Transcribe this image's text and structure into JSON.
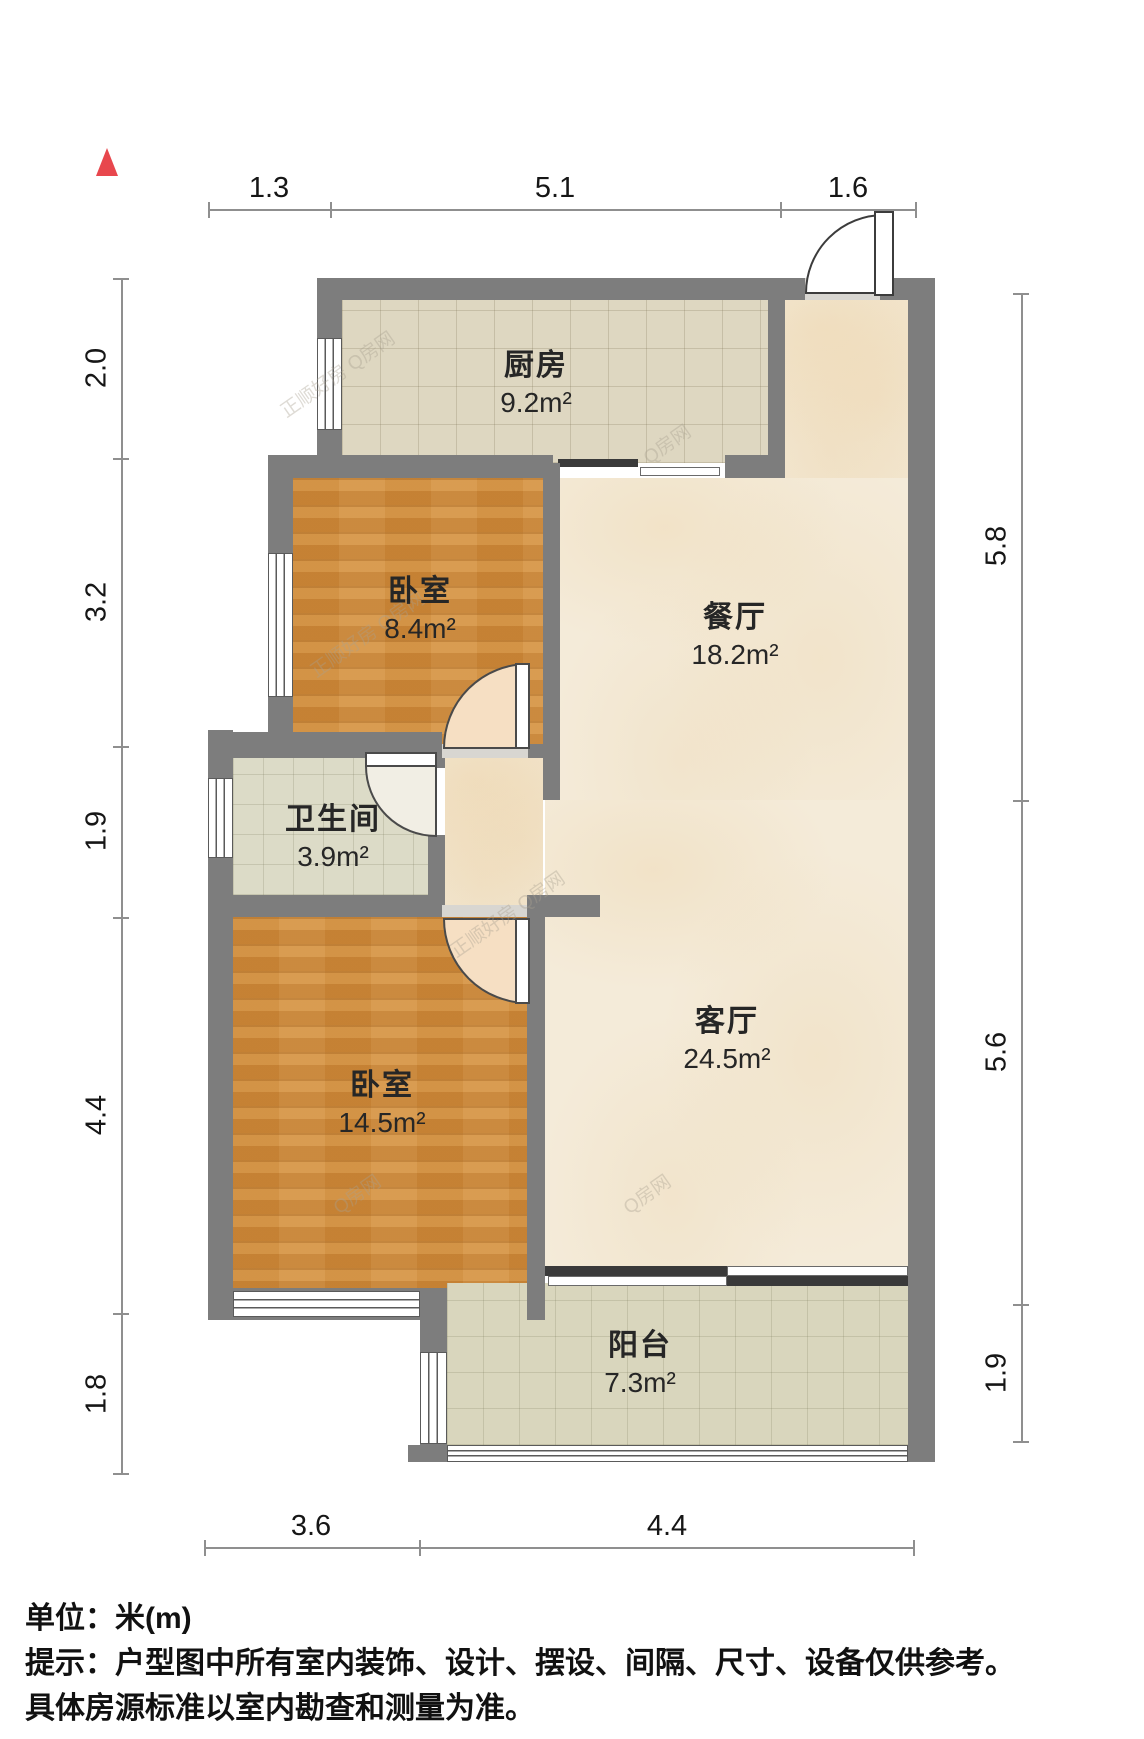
{
  "rooms": {
    "kitchen": {
      "name": "厨房",
      "area": "9.2m²"
    },
    "bedroom1": {
      "name": "卧室",
      "area": "8.4m²"
    },
    "dining": {
      "name": "餐厅",
      "area": "18.2m²"
    },
    "bathroom": {
      "name": "卫生间",
      "area": "3.9m²"
    },
    "bedroom2": {
      "name": "卧室",
      "area": "14.5m²"
    },
    "living": {
      "name": "客厅",
      "area": "24.5m²"
    },
    "balcony": {
      "name": "阳台",
      "area": "7.3m²"
    }
  },
  "dims": {
    "top": [
      "1.3",
      "5.1",
      "1.6"
    ],
    "left": [
      "2.0",
      "3.2",
      "1.9",
      "4.4",
      "1.8"
    ],
    "right": [
      "5.8",
      "5.6",
      "1.9"
    ],
    "bottom": [
      "3.6",
      "4.4"
    ]
  },
  "footer": {
    "unit": "单位：米(m)",
    "note_line1": "提示：户型图中所有室内装饰、设计、摆设、间隔、尺寸、设备仅供参考。",
    "note_line2": "具体房源标准以室内勘查和测量为准。"
  },
  "watermark": {
    "text": "正顺好房 Q房网",
    "site": "Q房网"
  },
  "colors": {
    "wall": "#7d7d7d",
    "wood_floor": "#d18d3c",
    "marble_floor": "#f4ebd9",
    "tile_floor": "#ded7c1",
    "north_marker": "#e8474d",
    "dimension_line": "#8f8f8f"
  }
}
